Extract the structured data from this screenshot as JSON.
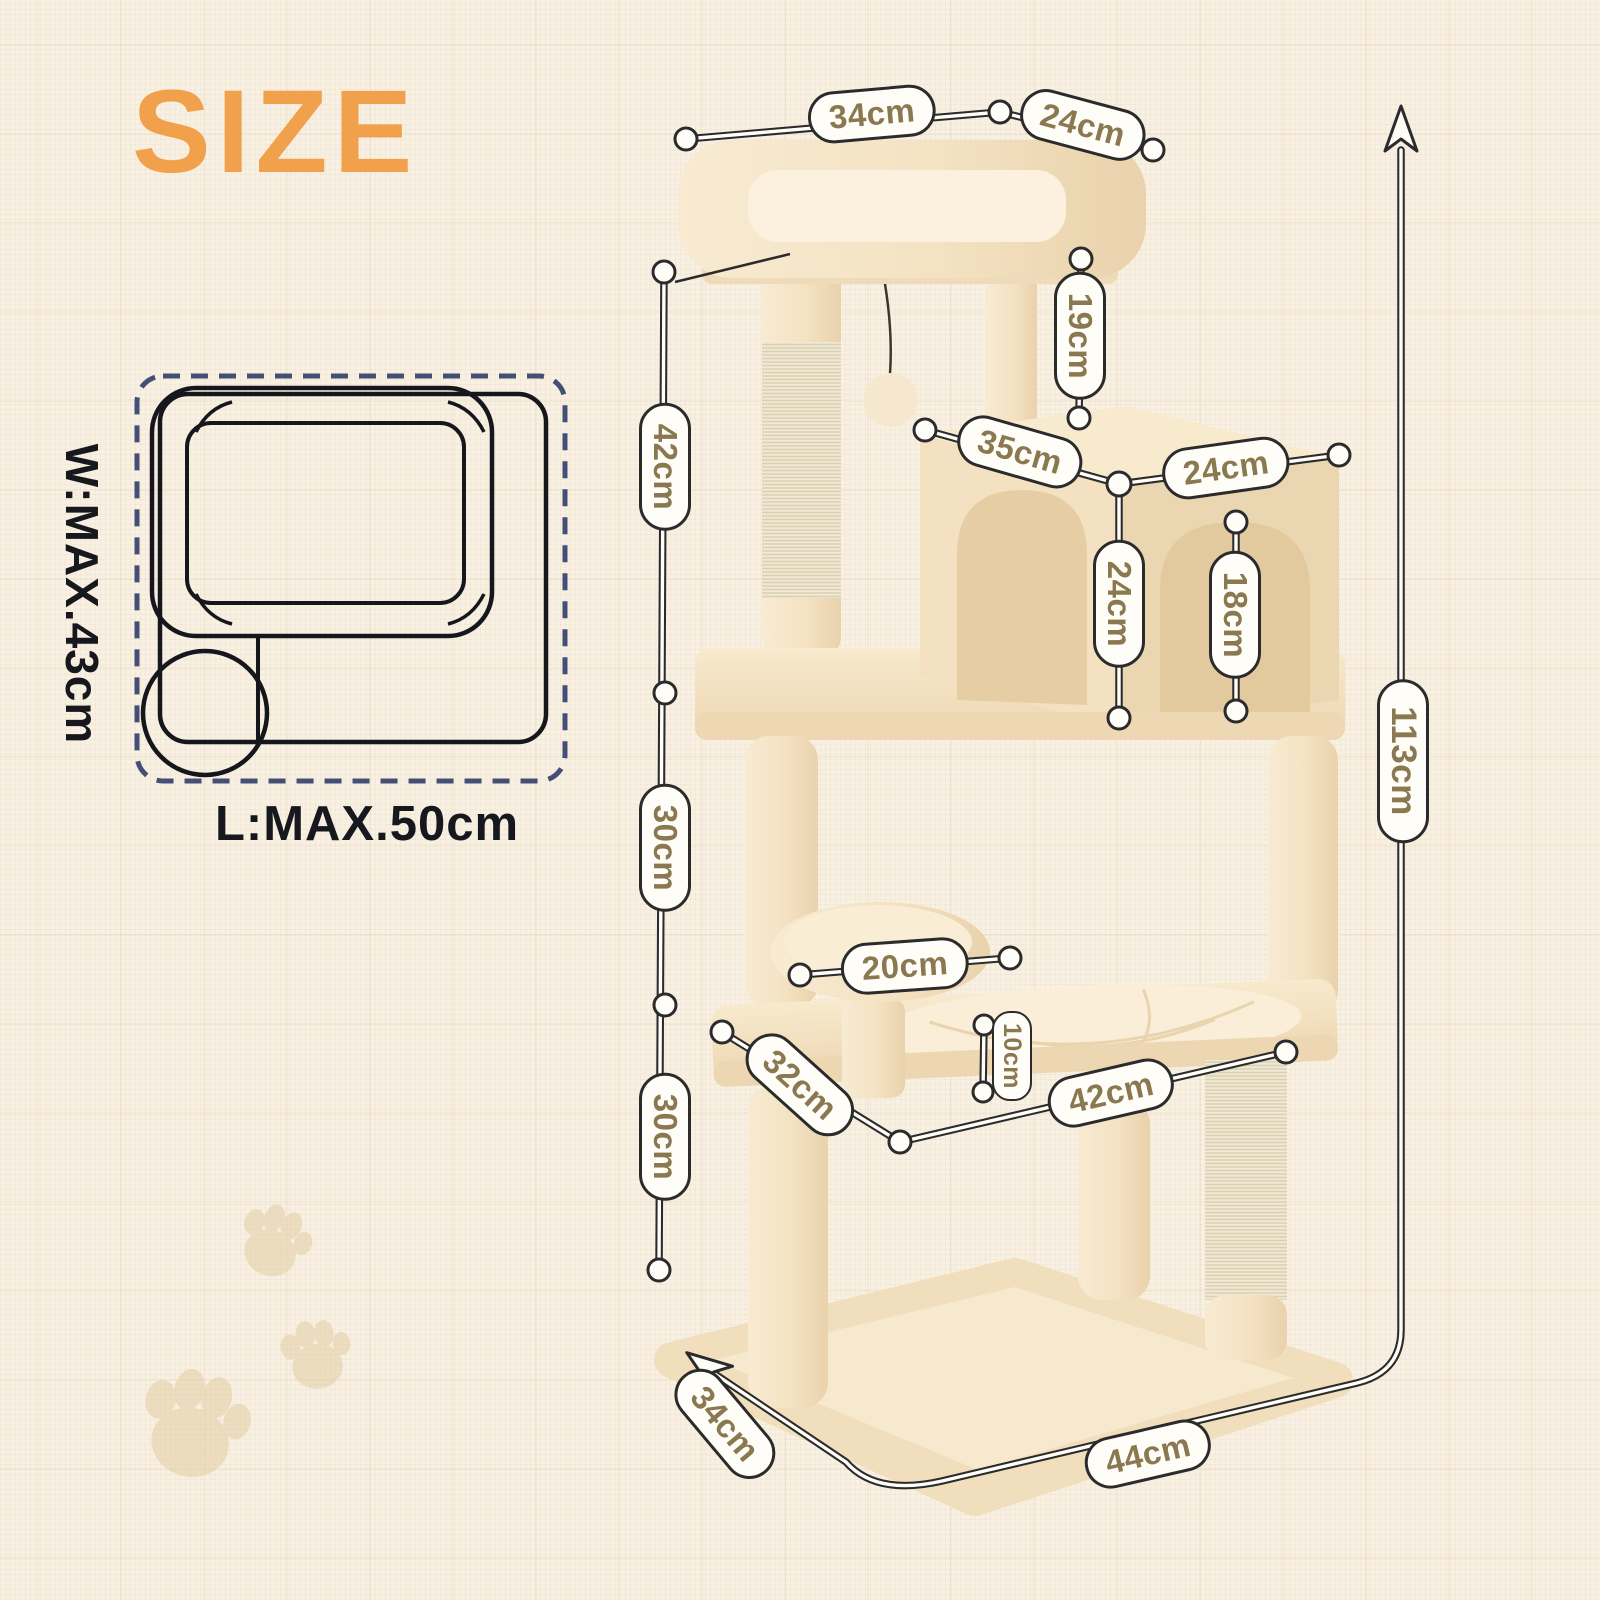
{
  "title": "SIZE",
  "bed_size_diagram": {
    "width_label": "W:MAX.43cm",
    "length_label": "L:MAX.50cm"
  },
  "dimension_labels": {
    "top_bed_length": "34cm",
    "top_bed_width": "24cm",
    "top_post_height": "19cm",
    "upper_post_height": "42cm",
    "condo_length": "35cm",
    "condo_width": "24cm",
    "condo_height": "24cm",
    "condo_door_height": "18cm",
    "total_height": "113cm",
    "middle_section_height": "30cm",
    "lower_section_height": "30cm",
    "perch_diameter": "20cm",
    "perch_post_height": "10cm",
    "hammock_platform_width": "32cm",
    "hammock_platform_length": "42cm",
    "base_width": "34cm",
    "base_length": "44cm"
  },
  "colors": {
    "accent": "#F1A14B",
    "label_text": "#8A7950",
    "outline": "#2B2B2B",
    "background": "#F8F0E2",
    "dashed_border": "#454F76",
    "plush_beige": "#F4E2C2",
    "sisal": "#EFE9D6"
  },
  "icons": {
    "paw_prints": "paw-print-icon",
    "height_arrow": "arrow-up-icon",
    "base_arrow": "arrow-diagonal-icon"
  }
}
